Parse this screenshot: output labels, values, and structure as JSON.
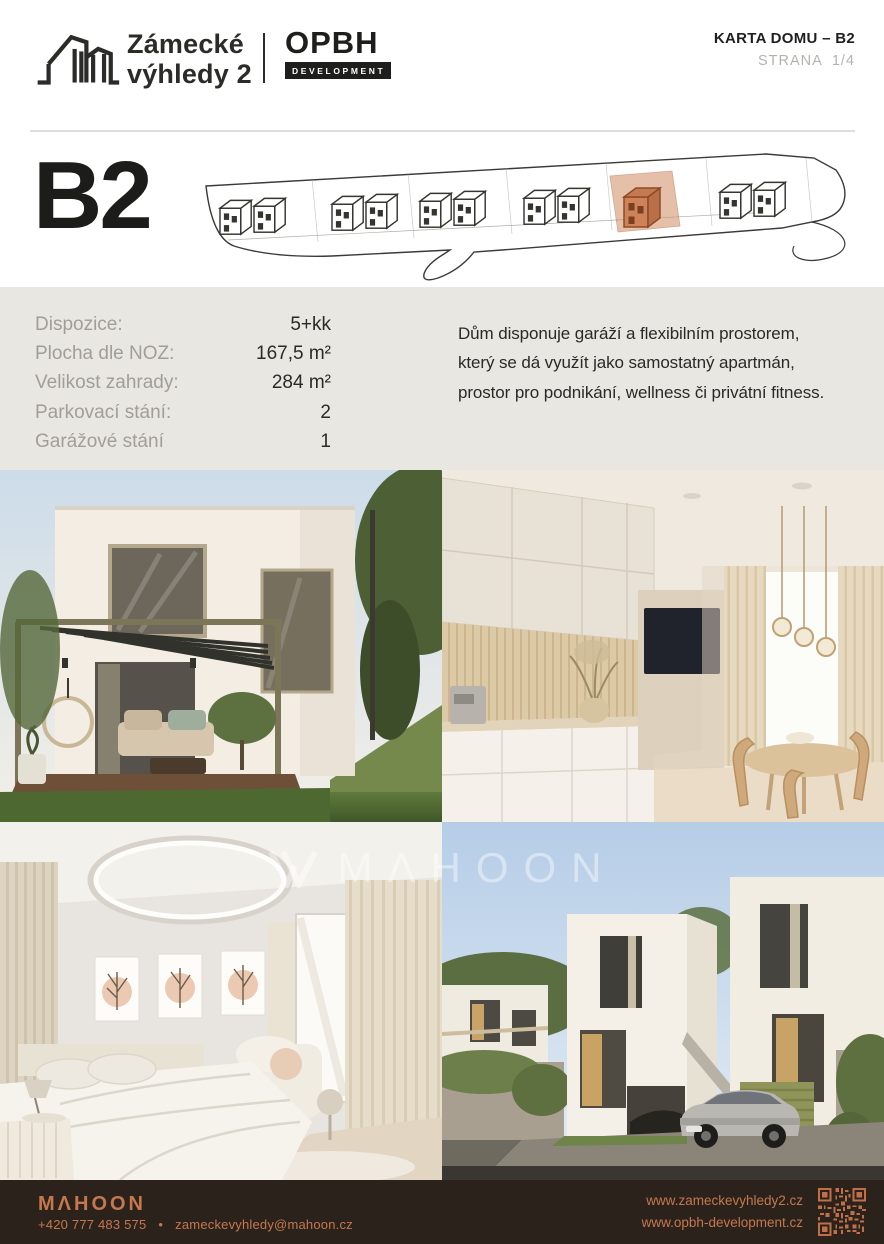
{
  "header": {
    "brand": {
      "title_line1": "Zámecké",
      "title_line2": "výhledy 2"
    },
    "partner": {
      "name": "OPBH",
      "sub": "DEVELOPMENT"
    },
    "doc_title": "KARTA DOMU – B2",
    "page_label": "STRANA",
    "page_number": "1/4"
  },
  "hero": {
    "house_id": "B2"
  },
  "details": {
    "rows": [
      {
        "label": "Dispozice:",
        "value": "5+kk"
      },
      {
        "label": "Plocha dle NOZ:",
        "value": "167,5 m²"
      },
      {
        "label": "Velikost zahrady:",
        "value": "284 m²"
      },
      {
        "label": "Parkovací stání:",
        "value": "2"
      },
      {
        "label": "Garážové stání",
        "value": "1"
      }
    ],
    "description_lines": [
      "Dům disponuje garáží a flexibilním prostorem,",
      "který se dá využít jako samostatný apartmán,",
      "prostor pro podnikání, wellness či privátní fitness."
    ]
  },
  "photos": [
    {
      "name": "exterior-pergola-render"
    },
    {
      "name": "kitchen-dining-render"
    },
    {
      "name": "bedroom-render"
    },
    {
      "name": "street-houses-render"
    }
  ],
  "watermark": "MΛHOON",
  "footer": {
    "brand": "MΛHOON",
    "phone": "+420 777 483 575",
    "separator": "•",
    "email": "zameckevyhledy@mahoon.cz",
    "website1": "www.zameckevyhledy2.cz",
    "website2": "www.opbh-development.cz"
  },
  "colors": {
    "accent_orange": "#c5774f",
    "footer_background": "#2b221c",
    "band_background": "#e9e7e2",
    "highlight_house": "#cd8257",
    "text_dark": "#2a2a27",
    "label_grey": "#a19e98"
  }
}
